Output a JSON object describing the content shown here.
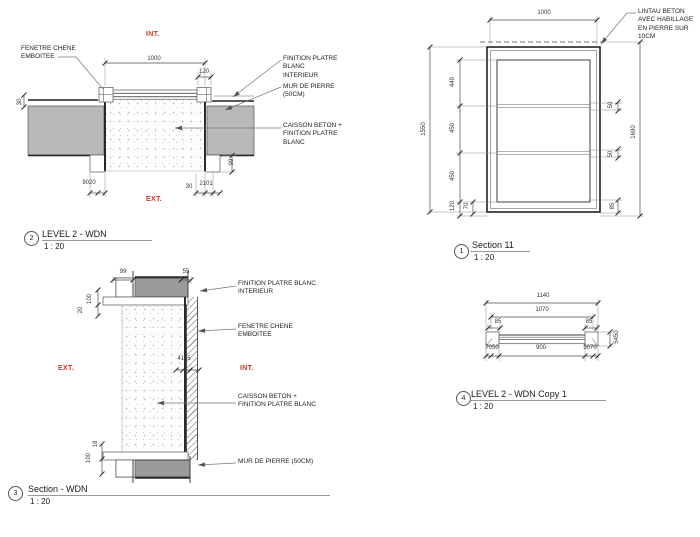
{
  "colors": {
    "accent_red": "#c0392b",
    "wall_gray": "#b9b9b9",
    "wall_gray_dark": "#9b9b9b",
    "line": "#444444"
  },
  "views": {
    "plan": {
      "number": "2",
      "title": "LEVEL 2 - WDN",
      "scale": "1 : 20",
      "int_label": "INT.",
      "ext_label": "EXT.",
      "callouts": {
        "fenetre": "FENETRE CHENE\nEMBOITEE",
        "finition": "FINITION PLATRE BLANC\nINTERIEUR",
        "mur": "MUR DE PIERRE (50CM)",
        "caisson": "CAISSON BETON +\nFINITION PLATRE BLANC"
      },
      "dims": {
        "opening": "1000",
        "reveal": "120",
        "v30": "30",
        "b_left": "9020",
        "b_mid": "30",
        "b_right": "2101",
        "notch": "99"
      }
    },
    "elevation": {
      "number": "1",
      "title": "Section 11",
      "scale": "1 : 20",
      "callouts": {
        "lintau": "LINTAU BETON\nAVEC HABILLAGE\nEN PIERRE SUR\n10CM"
      },
      "dims": {
        "top": "1000",
        "p1": "449",
        "p2": "450",
        "p3": "450",
        "p4": "120",
        "p5": "70",
        "left_total": "1550",
        "r1": "50",
        "r2": "50",
        "r3": "85",
        "right_total": "1690"
      }
    },
    "section": {
      "number": "3",
      "title": "Section - WDN",
      "scale": "1 : 20",
      "int_label": "INT.",
      "ext_label": "EXT.",
      "callouts": {
        "finition": "FINITION PLATRE BLANC\nINTERIEUR",
        "fenetre": "FENETRE CHENE\nEMBOITEE",
        "caisson": "CAISSON BETON +\nFINITION PLATRE BLANC",
        "mur": "MUR DE PIERRE (50CM)"
      },
      "dims": {
        "t1": "99",
        "t2": "55",
        "l1": "100",
        "l2": "20",
        "mid": "4165",
        "b1": "18",
        "b2": "100"
      }
    },
    "plan_copy": {
      "number": "4",
      "title": "LEVEL 2 - WDN Copy 1",
      "scale": "1 : 20",
      "dims": {
        "w1": "1140",
        "w2": "1070",
        "e_l": "85",
        "e_r": "85",
        "side": "5450",
        "b1": "7050",
        "b2": "900",
        "b3": "5070"
      }
    }
  }
}
